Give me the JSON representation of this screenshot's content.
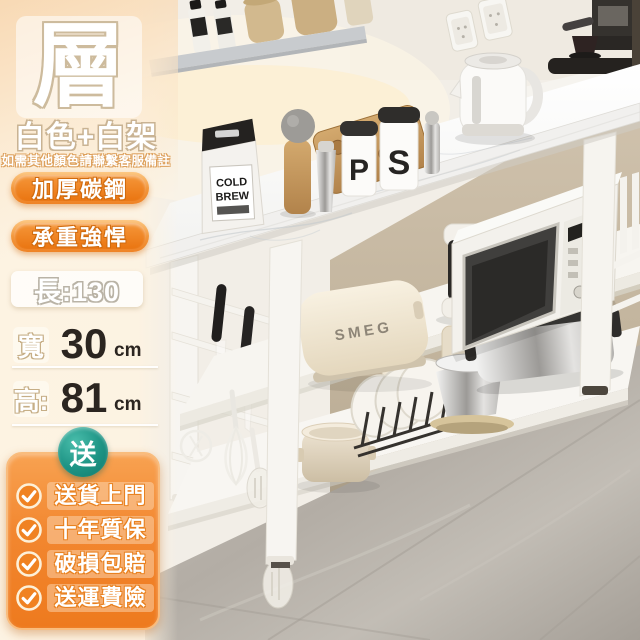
{
  "left_panel": {
    "headline_char": "層",
    "variant": "白色+白架",
    "note": "如需其他顏色請聯繫客服備註",
    "badges": [
      {
        "label": "加厚碳鋼"
      },
      {
        "label": "承重強悍"
      }
    ],
    "dimensions": {
      "length_label": "長:130",
      "width_label": "寬",
      "width_value": "30",
      "width_unit": "cm",
      "height_label": "高:",
      "height_value": "81",
      "height_unit": "cm"
    }
  },
  "promo": {
    "badge_char": "送",
    "items": [
      {
        "label": "送貨上門"
      },
      {
        "label": "十年質保"
      },
      {
        "label": "破損包賠"
      },
      {
        "label": "送運費險"
      }
    ]
  },
  "photo": {
    "toaster_brand": "SMEG",
    "jar_letter_p": "P",
    "jar_letter_s": "S",
    "coffee_bag_line1": "COLD",
    "coffee_bag_line2": "BREW"
  },
  "colors": {
    "accent_orange": "#ef7a1e",
    "badge_orange_light": "#fcc783",
    "promo_teal": "#1d9384",
    "panel_cream": "#fdf3e2",
    "text_dark": "#2b2520",
    "marble_white": "#fbfafa",
    "floor_gray": "#b8b2aa"
  }
}
